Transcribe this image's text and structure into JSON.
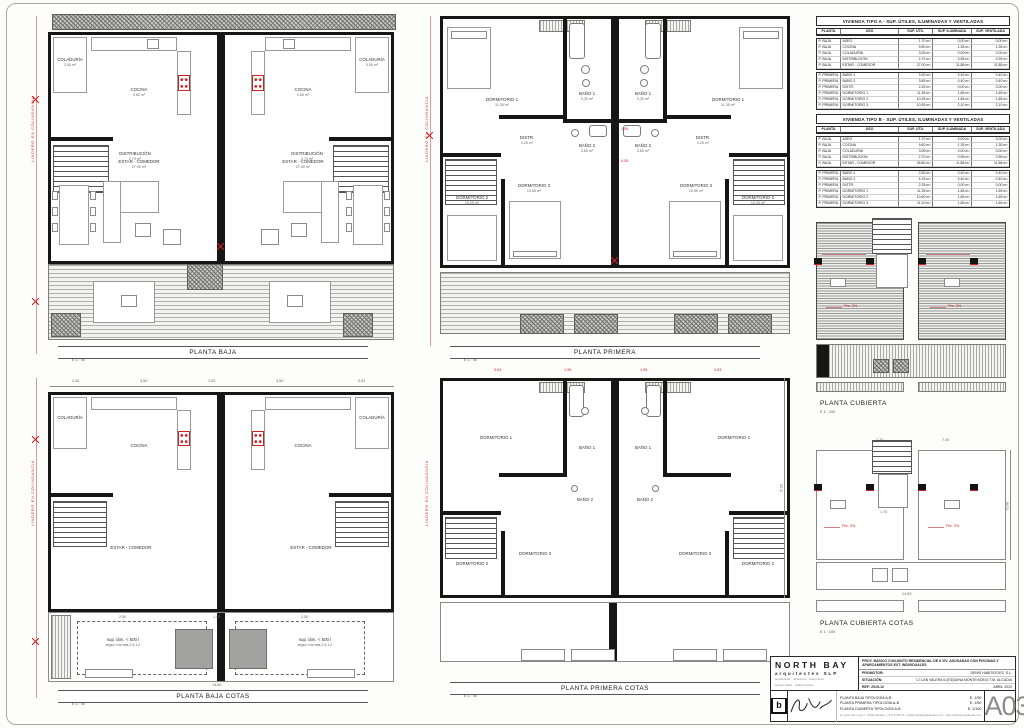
{
  "boundary_label": "LINDERO EN COLINDANCIA",
  "plans": {
    "baja": {
      "title": "PLANTA BAJA",
      "scale": "E 1 : 50"
    },
    "primera": {
      "title": "PLANTA PRIMERA",
      "scale": "E 1 : 50",
      "red_dims": [
        "1.95",
        "4.05"
      ]
    },
    "cubierta": {
      "title": "PLANTA CUBIERTA",
      "scale": "E 1 : 100",
      "slope_note": "Pte. 2%"
    },
    "baja_cotas": {
      "title": "PLANTA BAJA COTAS",
      "scale": "E 1 : 50",
      "top_dims": [
        "2.40",
        "3.50",
        "1.00",
        "3.50",
        "0.51"
      ],
      "pool_dims": [
        "2.50",
        "1.00",
        "2.50"
      ],
      "bottom_dim": "14.80",
      "pool_note_line1": "sup. lám. < 500 l",
      "pool_note_line2": "según normas 2.5.1.2"
    },
    "primera_cotas": {
      "title": "PLANTA PRIMERA COTAS",
      "scale": "E 1 : 50",
      "top_dims": [
        "3.63",
        "1.95",
        "1.95",
        "3.63"
      ],
      "side_dim": "5.95"
    },
    "cubierta_cotas": {
      "title": "PLANTA CUBIERTA COTAS",
      "scale": "E 1 : 100",
      "slope_note": "Pte. 2%",
      "top_dims": [
        "1.70",
        "7.40"
      ],
      "side_dim": "6.08",
      "bottom_dim": "14.80",
      "well_dim": "1.70"
    }
  },
  "rooms": {
    "coladuria": "COLADURÍA",
    "coladuria_area": "3.05 m²",
    "cocina": "COCINA",
    "cocina_area": "9.80 m²",
    "distribucion": "DISTRIBUCIÓN",
    "distribucion_area": "2.70 m²",
    "aseo": "ASEO",
    "aseo_area": "1.70 m²",
    "estar": "ESTAR - COMEDOR",
    "estar_area": "27.00 m²",
    "dorm1": "DORMITORIO 1",
    "dorm1_area": "11.35 m²",
    "dorm2": "DORMITORIO 2",
    "dorm2_area": "10.25 m²",
    "dorm3": "DORMITORIO 3",
    "dorm3_area": "10.55 m²",
    "bano1": "BAÑO 1",
    "bano1_area": "3.30 m²",
    "bano2": "BAÑO 2",
    "bano2_area": "3.65 m²",
    "distr": "DISTR.",
    "distr_area": "2.25 m²"
  },
  "tables": [
    {
      "title": "VIVIENDA TIPO A - SUP. ÚTILES, ILUMINADAS Y VENTILADAS",
      "headers": [
        "PLANTA",
        "USO",
        "SUP. ÚTIL",
        "SUP. ILUMINADA",
        "SUP. VENTILADA"
      ],
      "groups": [
        [
          [
            "P. BAJA",
            "ASEO",
            "1.70 m²",
            "0.00 m²",
            "0.00 m²"
          ],
          [
            "P. BAJA",
            "COCINA",
            "9.80 m²",
            "1.35 m²",
            "1.35 m²"
          ],
          [
            "P. BAJA",
            "COLADURÍA",
            "3.05 m²",
            "0.00 m²",
            "0.00 m²"
          ],
          [
            "P. BAJA",
            "DISTRIBUCIÓN",
            "2.70 m²",
            "0.95 m²",
            "0.95 m²"
          ],
          [
            "P. BAJA",
            "ESTAR - COMEDOR",
            "27.00 m²",
            "11.88 m²",
            "11.88 m²"
          ]
        ],
        [
          [
            "P. PRIMERA",
            "BAÑO 1",
            "3.30 m²",
            "0.40 m²",
            "0.40 m²"
          ],
          [
            "P. PRIMERA",
            "BAÑO 2",
            "3.65 m²",
            "0.40 m²",
            "0.40 m²"
          ],
          [
            "P. PRIMERA",
            "DISTR.",
            "2.25 m²",
            "0.00 m²",
            "0.00 m²"
          ],
          [
            "P. PRIMERA",
            "DORMITORIO 1",
            "11.35 m²",
            "1.65 m²",
            "1.65 m²"
          ],
          [
            "P. PRIMERA",
            "DORMITORIO 2",
            "10.25 m²",
            "1.65 m²",
            "1.65 m²"
          ],
          [
            "P. PRIMERA",
            "DORMITORIO 3",
            "10.55 m²",
            "2.10 m²",
            "2.10 m²"
          ]
        ]
      ]
    },
    {
      "title": "VIVIENDA TIPO B - SUP. ÚTILES, ILUMINADAS Y VENTILADAS",
      "headers": [
        "PLANTA",
        "USO",
        "SUP. ÚTIL",
        "SUP. ILUMINADA",
        "SUP. VENTILADA"
      ],
      "groups": [
        [
          [
            "P. BAJA",
            "ASEO",
            "1.70 m²",
            "0.00 m²",
            "0.00 m²"
          ],
          [
            "P. BAJA",
            "COCINA",
            "9.60 m²",
            "1.35 m²",
            "1.35 m²"
          ],
          [
            "P. BAJA",
            "COLADURÍA",
            "3.05 m²",
            "0.00 m²",
            "0.00 m²"
          ],
          [
            "P. BAJA",
            "DISTRIBUCIÓN",
            "2.70 m²",
            "0.95 m²",
            "0.95 m²"
          ],
          [
            "P. BAJA",
            "ESTAR - COMEDOR",
            "26.80 m²",
            "11.88 m²",
            "11.88 m²"
          ]
        ],
        [
          [
            "P. PRIMERA",
            "BAÑO 1",
            "3.30 m²",
            "0.40 m²",
            "0.40 m²"
          ],
          [
            "P. PRIMERA",
            "BAÑO 2",
            "4.15 m²",
            "0.40 m²",
            "0.40 m²"
          ],
          [
            "P. PRIMERA",
            "DISTR.",
            "2.25 m²",
            "0.00 m²",
            "0.00 m²"
          ],
          [
            "P. PRIMERA",
            "DORMITORIO 1",
            "11.35 m²",
            "1.65 m²",
            "1.65 m²"
          ],
          [
            "P. PRIMERA",
            "DORMITORIO 2",
            "10.60 m²",
            "1.65 m²",
            "1.65 m²"
          ],
          [
            "P. PRIMERA",
            "DORMITORIO 3",
            "11.10 m²",
            "1.65 m²",
            "1.65 m²"
          ]
        ]
      ]
    }
  ],
  "titleblock": {
    "firm_name": "NORTH BAY",
    "firm_sub": "arquitectes SLP",
    "firm_small1": "arquitectura · urbanisme · interiorisme",
    "firm_small2": "Ignacio Salas · Gabriel Sastre",
    "logo_letter": "b",
    "project": "PROY. BÁSICO CONJUNTO RESIDENCIAL DE 6 VIV. ADOSADAS CON PISCINAS Y APARCAMIENTOS EXT. INDIVIDUALES",
    "promotor_label": "PROMOTOR:",
    "promotor": "DENIS HABITATGES, S.L.",
    "situacion_label": "SITUACIÓN:",
    "situacion": "C/ CAN VALERA 6 (ESQUINA MONTEVIDEU) T.M. ALCÚDIA",
    "ref": "REF: 2019-12",
    "date": "ABRIL 2020",
    "drawings": [
      {
        "title": "PLANTA BAJA TIPOLOGÍA A-B",
        "scale": "E: 1/50"
      },
      {
        "title": "PLANTA PRIMERA TIPOLOGÍA A-B",
        "scale": "E: 1/50"
      },
      {
        "title": "PLANTA CUBIERTA TIPOLOGÍA A-B",
        "scale": "E: 1/100"
      }
    ],
    "footer": "av. pere mas i reus 7 · 07400 alcúdia · t. 971 54 88 10 · info@northbayarquitectes.com · www.northbayarquitectes.com",
    "sheet_number": "A03"
  }
}
